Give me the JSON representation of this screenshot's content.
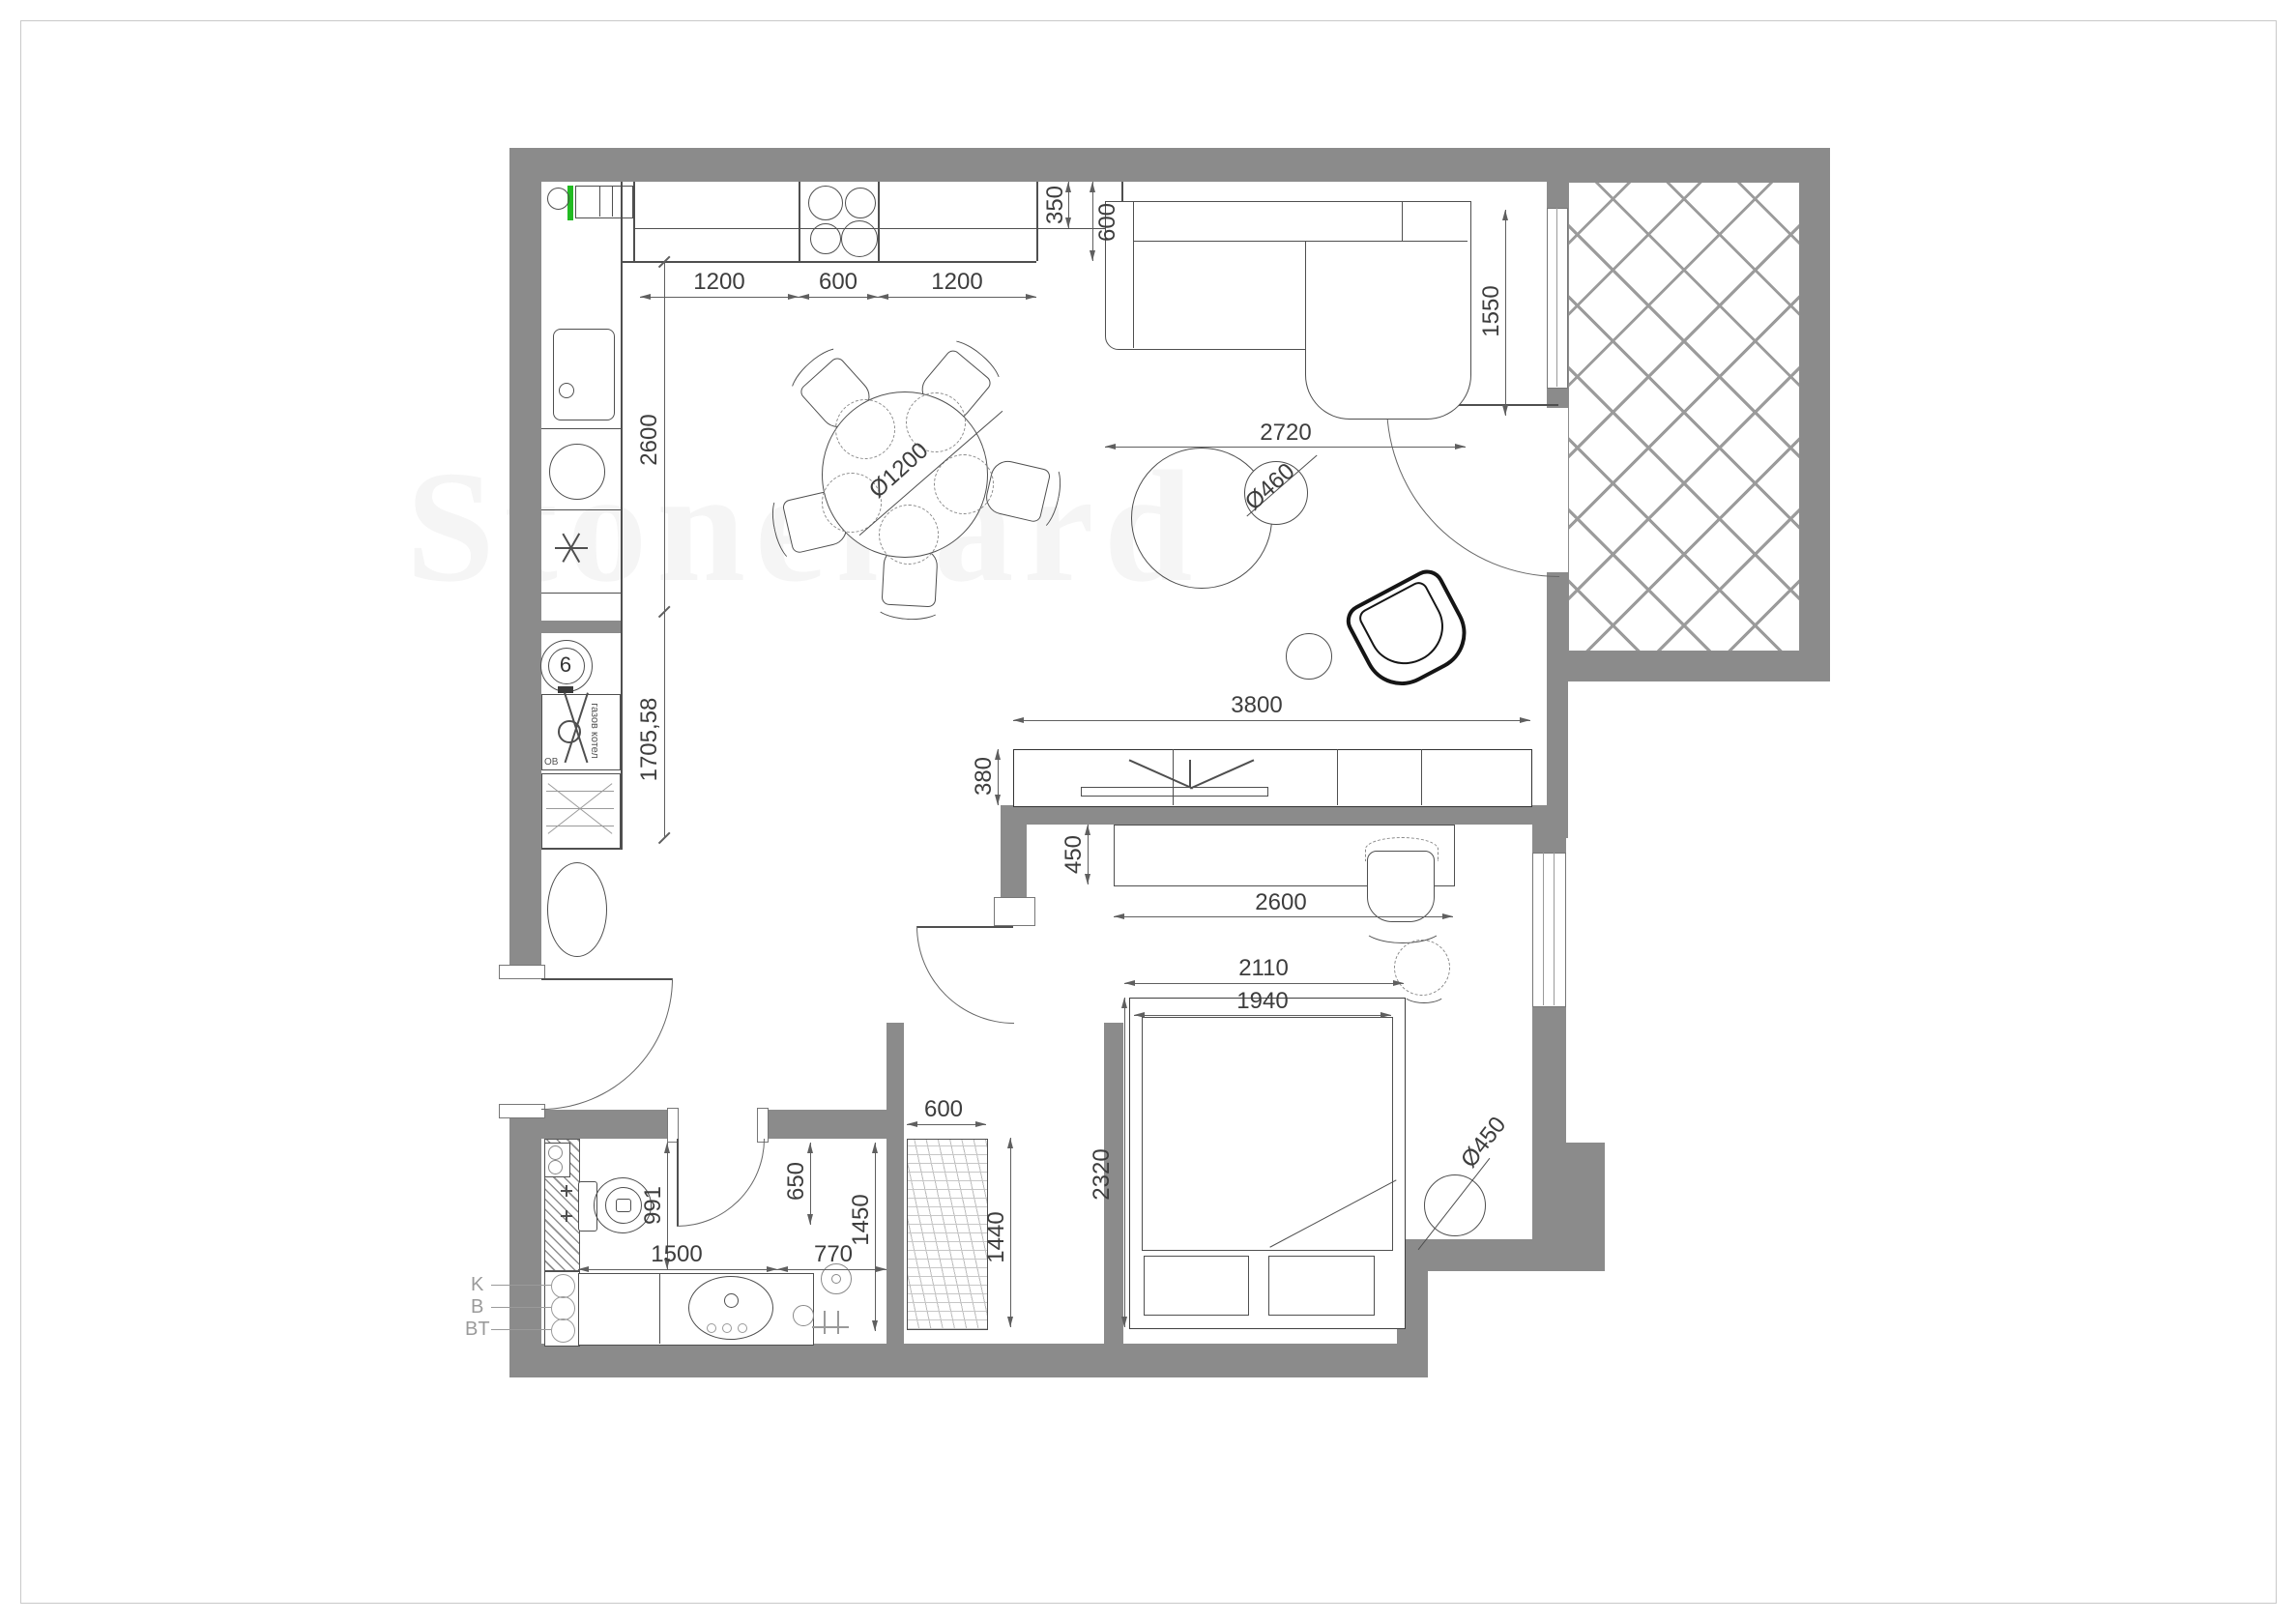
{
  "meta": {
    "type": "architectural-floor-plan",
    "wall_color": "#8b8b8b",
    "accent_green": "#22bb22",
    "hatch_color": "#9b9b9b",
    "line_color": "#4f4f4f"
  },
  "watermark": {
    "text": "Stonehard"
  },
  "dims": {
    "kitchen_seg_left": "1200",
    "kitchen_seg_mid": "600",
    "kitchen_seg_right": "1200",
    "counter_350": "350",
    "counter_600": "600",
    "kitchen_2600": "2600",
    "kitchen_1705": "1705,58",
    "sofa_1550": "1550",
    "sofa_2720": "2720",
    "tv_3800": "3800",
    "tv_380": "380",
    "desk_450": "450",
    "desk_2600": "2600",
    "bed_2110": "2110",
    "bed_1940": "1940",
    "bed_2320": "2320",
    "wardrobe_600": "600",
    "wardrobe_1440": "1440",
    "pouf_d450": "Ø450",
    "bath_991": "991",
    "bath_1500": "1500",
    "bath_770": "770",
    "bath_650": "650",
    "bath_1450": "1450",
    "table_d1200": "Ø1200",
    "coffee_d460": "Ø460"
  },
  "risers": {
    "k": "K",
    "b": "B",
    "bt": "BT"
  },
  "equipment": {
    "gas_meter": "6",
    "boiler": "газов котел",
    "boiler_ov": "ОВ"
  }
}
